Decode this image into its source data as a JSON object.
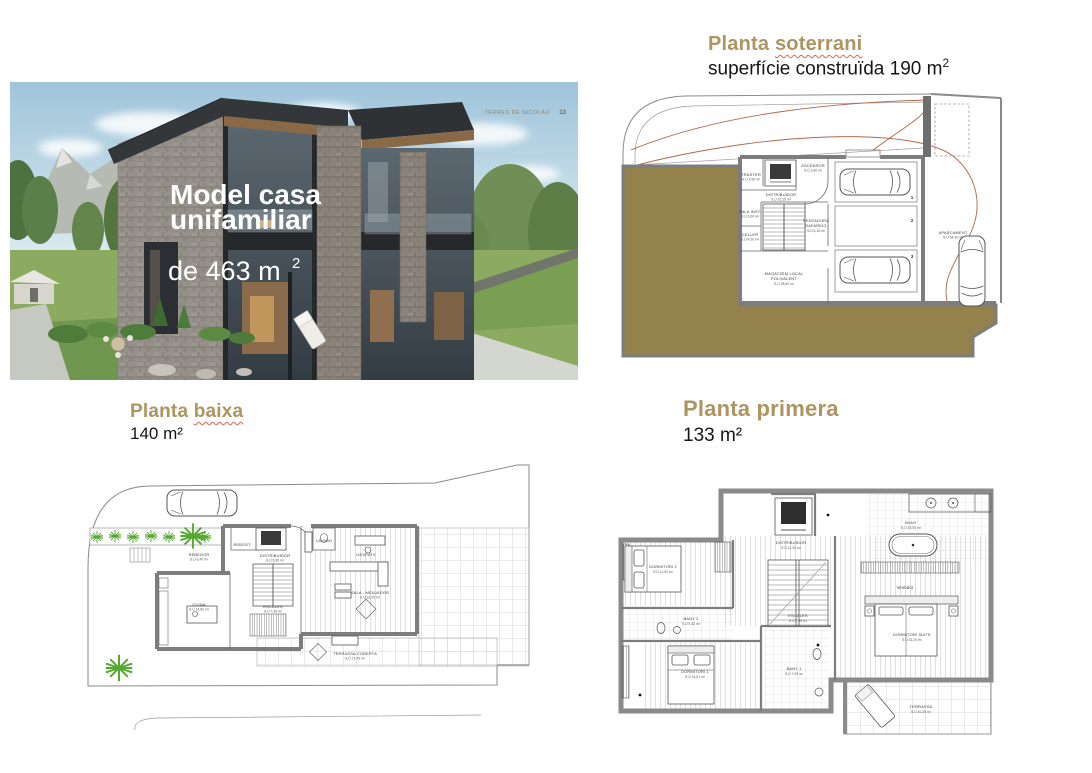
{
  "photo": {
    "title_line1": "Model casa",
    "title_line2": "unifamiliar",
    "area_main": "de 463 m",
    "area_sup": "2",
    "corner_text": "TERRES DE NICOLAU",
    "corner_page": "13"
  },
  "sections": {
    "soterrani": {
      "title_prefix": "Planta ",
      "title_word": "soterrani",
      "subtitle_main": "superfície construïda 190 m",
      "subtitle_sup": "2"
    },
    "baixa": {
      "title_prefix": "Planta ",
      "title_word": "baixa",
      "subtitle": "140 m²"
    },
    "primera": {
      "title": "Planta primera",
      "subtitle": "133 m²"
    }
  },
  "plans": {
    "soterrani": {
      "rooms": [
        {
          "name": "TRASTER",
          "area": "S.Ú 3,95 m²"
        },
        {
          "name": "ASCENSOR",
          "area": "S.Ú 2,80 m²"
        },
        {
          "name": "DISTRIBUÏDOR",
          "area": "S.Ú 10,25 m²"
        },
        {
          "name": "SALA INST.",
          "area": "S.Ú 3,60 m²"
        },
        {
          "name": "CELLER",
          "area": "S.Ú 4,20 m²"
        },
        {
          "name": "RENTADORA",
          "sub": "SAFAREIG",
          "area": "S.Ú 6,15 m²"
        },
        {
          "name": "MAGATZEM LOCAL",
          "sub": "POLIVALENT",
          "area": "S.Ú 28,60 m²"
        },
        {
          "name": "APARCAMENT",
          "area": "S.Ú 64,30 m²"
        }
      ],
      "stalls": [
        "1",
        "2",
        "3"
      ]
    },
    "baixa": {
      "rooms": [
        {
          "name": "REBOST"
        },
        {
          "name": "LAVABO"
        },
        {
          "name": "REBEDOR",
          "area": "S.Ú 6,40 m²"
        },
        {
          "name": "DISTRIBUÏDOR",
          "area": "S.Ú 5,90 m²"
        },
        {
          "name": "ESCALES",
          "area": "S.Ú 7,39 m²"
        },
        {
          "name": "CUINA",
          "area": "S.Ú 14,80 m²"
        },
        {
          "name": "DESPATX"
        },
        {
          "name": "SALA - MENJADOR",
          "area": "S.Ú 31,05 m²"
        },
        {
          "name": "TERRASSA COBERTA",
          "area": "S.Ú 21,45 m²"
        }
      ]
    },
    "primera": {
      "rooms": [
        {
          "name": "DORMITORI 2",
          "area": "S.Ú 11,52 m²"
        },
        {
          "name": "BANY 2",
          "area": "S.Ú 5,32 m²"
        },
        {
          "name": "DORMITORI 1",
          "area": "S.Ú 14,61 m²"
        },
        {
          "name": "DISTRIBUÏDOR",
          "area": "S.Ú 11,30 m²"
        },
        {
          "name": "ESCALES",
          "area": "S.Ú 7,39 m²"
        },
        {
          "name": "BANY 1",
          "area": "S.Ú 7,09 m²"
        },
        {
          "name": "BANY",
          "area": "S.Ú 15,05 m²"
        },
        {
          "name": "Vestidor"
        },
        {
          "name": "DORMITORI SUITE",
          "area": "S.Ú 31,20 m²"
        },
        {
          "name": "TERRASSA",
          "area": "S.Ú 10,39 m²"
        }
      ]
    }
  },
  "colors": {
    "accent_tan": "#ad9461",
    "spellcheck_red": "#e2614d",
    "earth_fill": "#93824c",
    "wall_gray": "#7d7d7d",
    "car_path_red": "#b4654a",
    "plant_green": "#55a830"
  }
}
